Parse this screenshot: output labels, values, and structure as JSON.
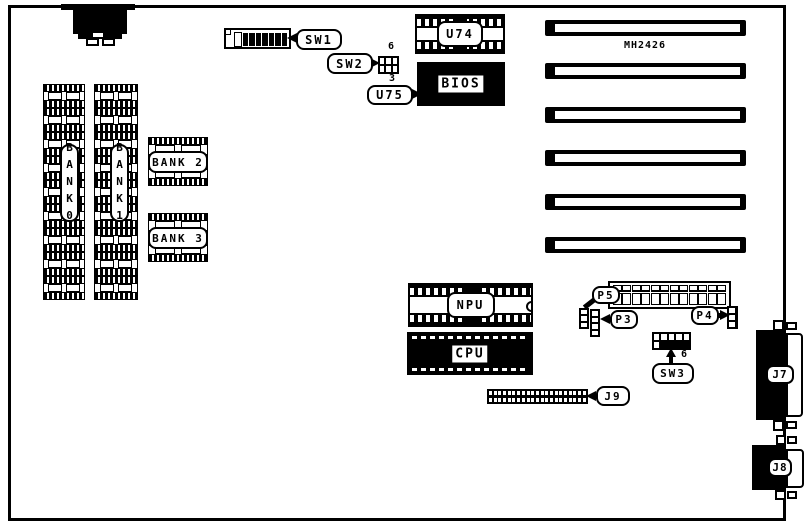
{
  "board": {
    "model": "MH2426"
  },
  "memory": {
    "bank0": "BANK0",
    "bank1": "BANK1",
    "bank2": "BANK 2",
    "bank3": "BANK 3",
    "column_chip_count": 9,
    "bank_row_chip_count": 2
  },
  "chips": {
    "u74": "U74",
    "u75": "U75",
    "bios": "BIOS",
    "npu": "NPU",
    "cpu": "CPU"
  },
  "switches": {
    "sw1": {
      "label": "SW1",
      "positions": 8
    },
    "sw2": {
      "label": "SW2",
      "pin_top": "6",
      "pin_bottom": "3",
      "cell_count": 6
    },
    "sw3": {
      "label": "SW3",
      "pin": "6",
      "top_cells": 5
    }
  },
  "connectors": {
    "p3": {
      "label": "P3",
      "pins": 4
    },
    "p4": {
      "label": "P4",
      "pins": 3
    },
    "p5": {
      "label": "P5",
      "pins": 3
    },
    "j7": {
      "label": "J7"
    },
    "j8": {
      "label": "J8"
    },
    "j9": {
      "label": "J9",
      "cols": 21
    },
    "power_header_cells": 12
  },
  "expansion_slots": {
    "count": 6
  }
}
